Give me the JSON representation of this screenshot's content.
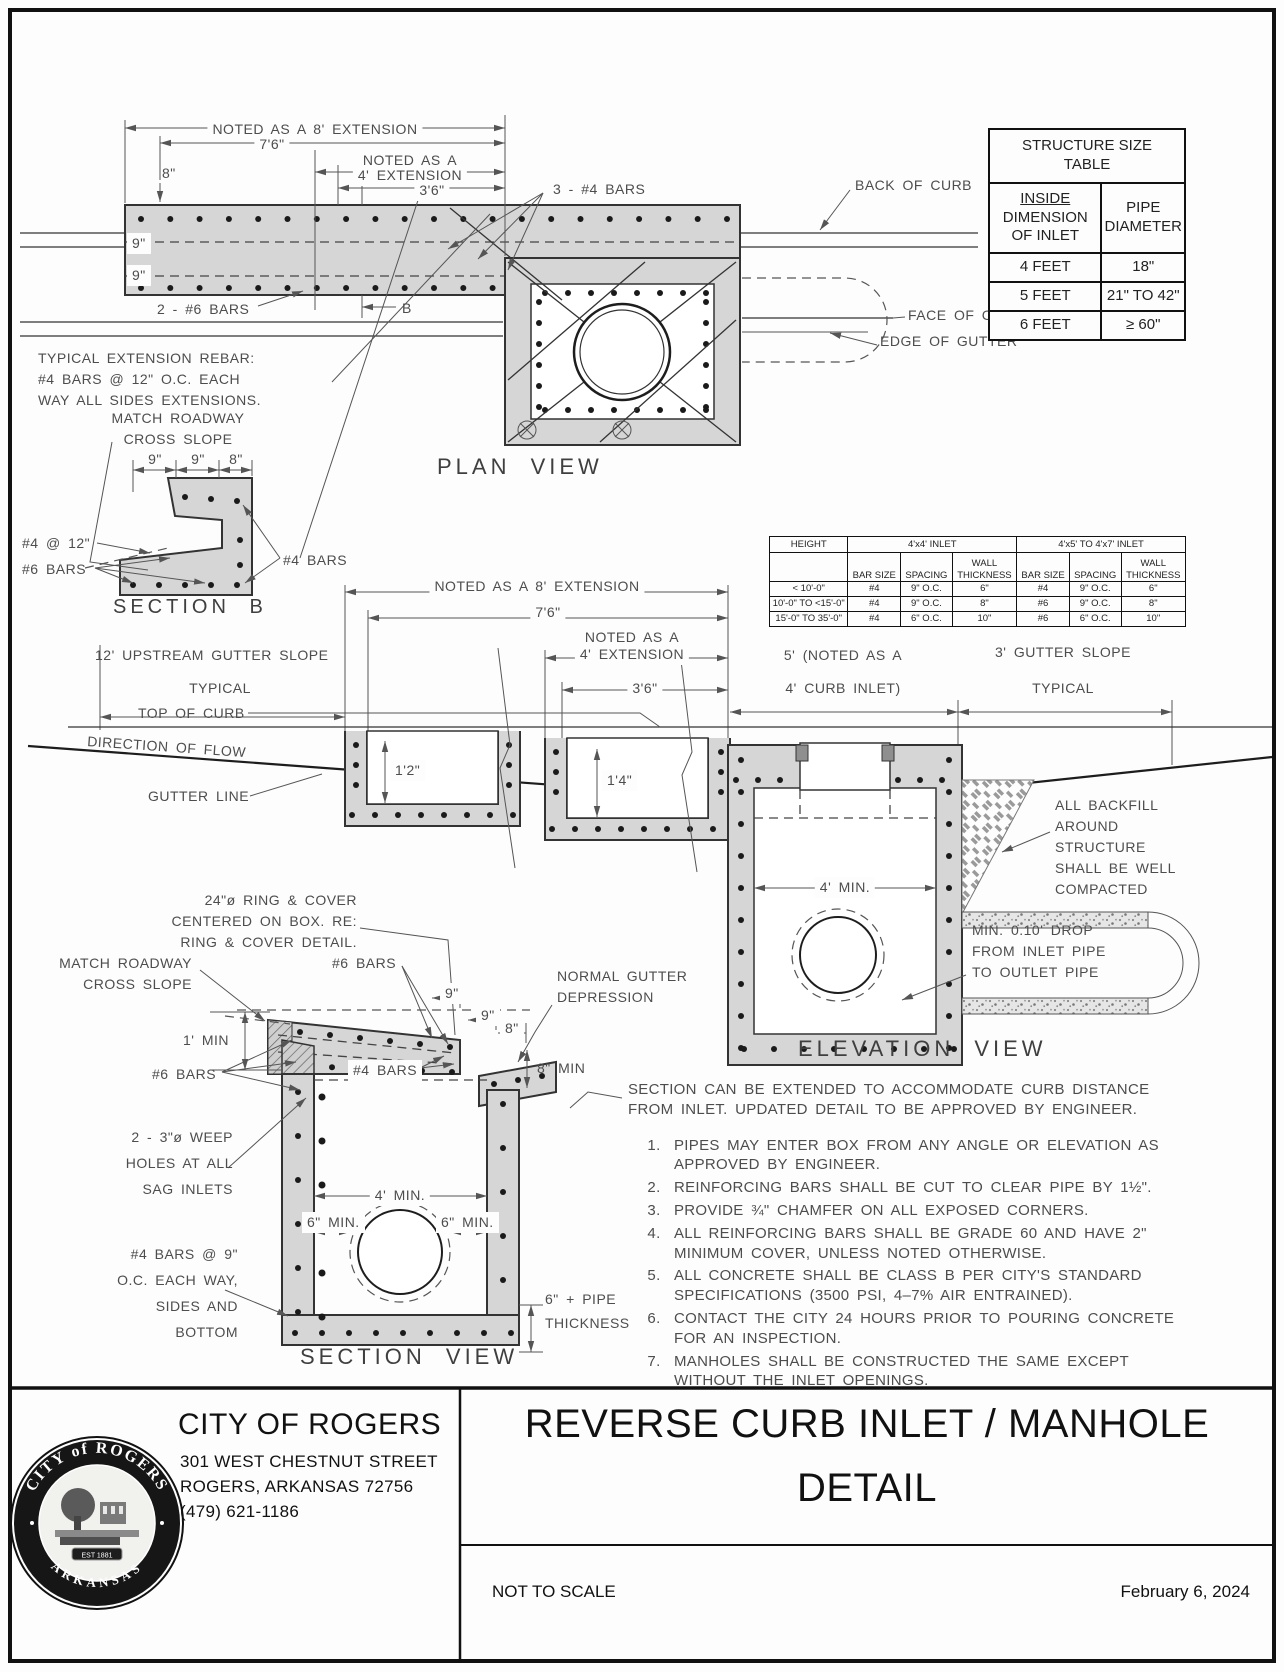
{
  "plan": {
    "title": "PLAN VIEW",
    "dim_ext8": "NOTED AS A 8' EXTENSION",
    "dim_76": "7'6\"",
    "dim_noted4_1": "NOTED AS A",
    "dim_noted4_2": "4' EXTENSION",
    "dim_36": "3'6\"",
    "dim_8in": "8\"",
    "dim_9a": "9\"",
    "dim_9b": "9\"",
    "label_2_6bars": "2 - #6 BARS",
    "label_3_4bars": "3 - #4 BARS",
    "label_b": "B",
    "back_of_curb": "BACK OF CURB",
    "face_of_curb": "FACE OF CURB",
    "edge_of_gutter": "EDGE OF GUTTER",
    "ext_note_1": "TYPICAL EXTENSION REBAR:",
    "ext_note_2": "#4 BARS @ 12\" O.C. EACH",
    "ext_note_3": "WAY ALL SIDES EXTENSIONS."
  },
  "structure_table": {
    "title_1": "STRUCTURE SIZE",
    "title_2": "TABLE",
    "col1_1": "INSIDE",
    "col1_2": "DIMENSION",
    "col1_3": "OF INLET",
    "col2_1": "PIPE",
    "col2_2": "DIAMETER",
    "rows": [
      [
        "4 FEET",
        "18\""
      ],
      [
        "5 FEET",
        "21\" TO 42\""
      ],
      [
        "6 FEET",
        "≥ 60\""
      ]
    ]
  },
  "section_b": {
    "title": "SECTION B",
    "match_1": "MATCH ROADWAY",
    "match_2": "CROSS SLOPE",
    "dim_9a": "9\"",
    "dim_9b": "9\"",
    "dim_8": "8\"",
    "label_4_12": "#4 @ 12\"",
    "label_6bars": "#6 BARS",
    "label_4bars": "#4 BARS"
  },
  "rebar_table": {
    "height": "HEIGHT",
    "group_4x4": "4'x4' INLET",
    "group_4x5": "4'x5' TO 4'x7' INLET",
    "sub_bar": "BAR SIZE",
    "sub_spacing": "SPACING",
    "sub_wall_1": "WALL",
    "sub_wall_2": "THICKNESS",
    "rows": [
      [
        "< 10'-0\"",
        "#4",
        "9\" O.C.",
        "6\"",
        "#4",
        "9\" O.C.",
        "6\""
      ],
      [
        "10'-0\" TO <15'-0\"",
        "#4",
        "9\" O.C.",
        "8\"",
        "#6",
        "9\" O.C.",
        "8\""
      ],
      [
        "15'-0\" TO 35'-0\"",
        "#4",
        "6\" O.C.",
        "10\"",
        "#6",
        "6\" O.C.",
        "10\""
      ]
    ]
  },
  "elevation": {
    "title": "ELEVATION VIEW",
    "dim_ext8": "NOTED AS A 8' EXTENSION",
    "dim_76": "7'6\"",
    "dim_noted4_1": "NOTED AS A",
    "dim_noted4_2": "4' EXTENSION",
    "dim_36": "3'6\"",
    "dim_5_1": "5' (NOTED AS A",
    "dim_5_2": "4' CURB INLET)",
    "dim_gutter3": "3' GUTTER SLOPE",
    "typical_r": "TYPICAL",
    "dim_upstream": "12' UPSTREAM GUTTER SLOPE",
    "typical_l": "TYPICAL",
    "top_of_curb": "TOP OF CURB",
    "direction_of_flow": "DIRECTION OF FLOW",
    "gutter_line": "GUTTER LINE",
    "dim_12": "1'2\"",
    "dim_14": "1'4\"",
    "dim_4min": "4' MIN.",
    "backfill_1": "ALL BACKFILL",
    "backfill_2": "AROUND",
    "backfill_3": "STRUCTURE",
    "backfill_4": "SHALL BE WELL",
    "backfill_5": "COMPACTED",
    "drop_1": "MIN. 0.10' DROP",
    "drop_2": "FROM INLET PIPE",
    "drop_3": "TO OUTLET PIPE"
  },
  "section_view": {
    "title": "SECTION VIEW",
    "ring_1": "24\"ø RING & COVER",
    "ring_2": "CENTERED ON BOX. RE:",
    "ring_3": "RING & COVER DETAIL.",
    "match_1": "MATCH ROADWAY",
    "match_2": "CROSS SLOPE",
    "dim_9a": "9\"",
    "dim_9b": "9\"",
    "dim_8": "8\"",
    "label_6bars_top": "#6 BARS",
    "normal_1": "NORMAL GUTTER",
    "normal_2": "DEPRESSION",
    "dim_1min": "1' MIN",
    "dim_8min": "8\" MIN",
    "label_6bars": "#6 BARS",
    "label_4bars": "#4 BARS",
    "weep_1": "2 - 3\"ø WEEP",
    "weep_2": "HOLES AT ALL",
    "weep_3": "SAG INLETS",
    "dim_4min": "4' MIN.",
    "dim_6min_l": "6\" MIN.",
    "dim_6min_r": "6\" MIN.",
    "bars9_1": "#4 BARS @ 9\"",
    "bars9_2": "O.C. EACH WAY,",
    "bars9_3": "SIDES AND",
    "bars9_4": "BOTTOM",
    "pipe_1": "6\" + PIPE",
    "pipe_2": "THICKNESS"
  },
  "notes": {
    "intro_1": "SECTION CAN BE EXTENDED TO ACCOMMODATE CURB DISTANCE",
    "intro_2": "FROM INLET. UPDATED DETAIL TO BE APPROVED BY ENGINEER.",
    "items": [
      "PIPES MAY ENTER BOX FROM ANY ANGLE OR ELEVATION AS APPROVED BY ENGINEER.",
      "REINFORCING BARS SHALL BE CUT TO CLEAR PIPE BY 1½\".",
      "PROVIDE ¾\" CHAMFER ON ALL EXPOSED CORNERS.",
      "ALL REINFORCING BARS SHALL BE GRADE 60 AND HAVE 2\" MINIMUM COVER, UNLESS NOTED OTHERWISE.",
      "ALL CONCRETE SHALL BE CLASS B PER CITY'S STANDARD SPECIFICATIONS (3500 PSI, 4–7% AIR ENTRAINED).",
      "CONTACT THE CITY 24 HOURS PRIOR TO POURING CONCRETE FOR AN INSPECTION.",
      "MANHOLES SHALL BE CONSTRUCTED THE SAME EXCEPT WITHOUT THE INLET OPENINGS."
    ]
  },
  "title_block": {
    "seal_top": "CITY of ROGERS",
    "seal_bottom": "ARKANSAS",
    "seal_est": "EST 1881",
    "org_name": "CITY OF ROGERS",
    "address_1": "301 WEST CHESTNUT STREET",
    "address_2": "ROGERS, ARKANSAS  72756",
    "phone": "(479) 621-1186",
    "sheet_title_1": "REVERSE CURB INLET / MANHOLE",
    "sheet_title_2": "DETAIL",
    "scale": "NOT TO SCALE",
    "date": "February 6, 2024"
  }
}
